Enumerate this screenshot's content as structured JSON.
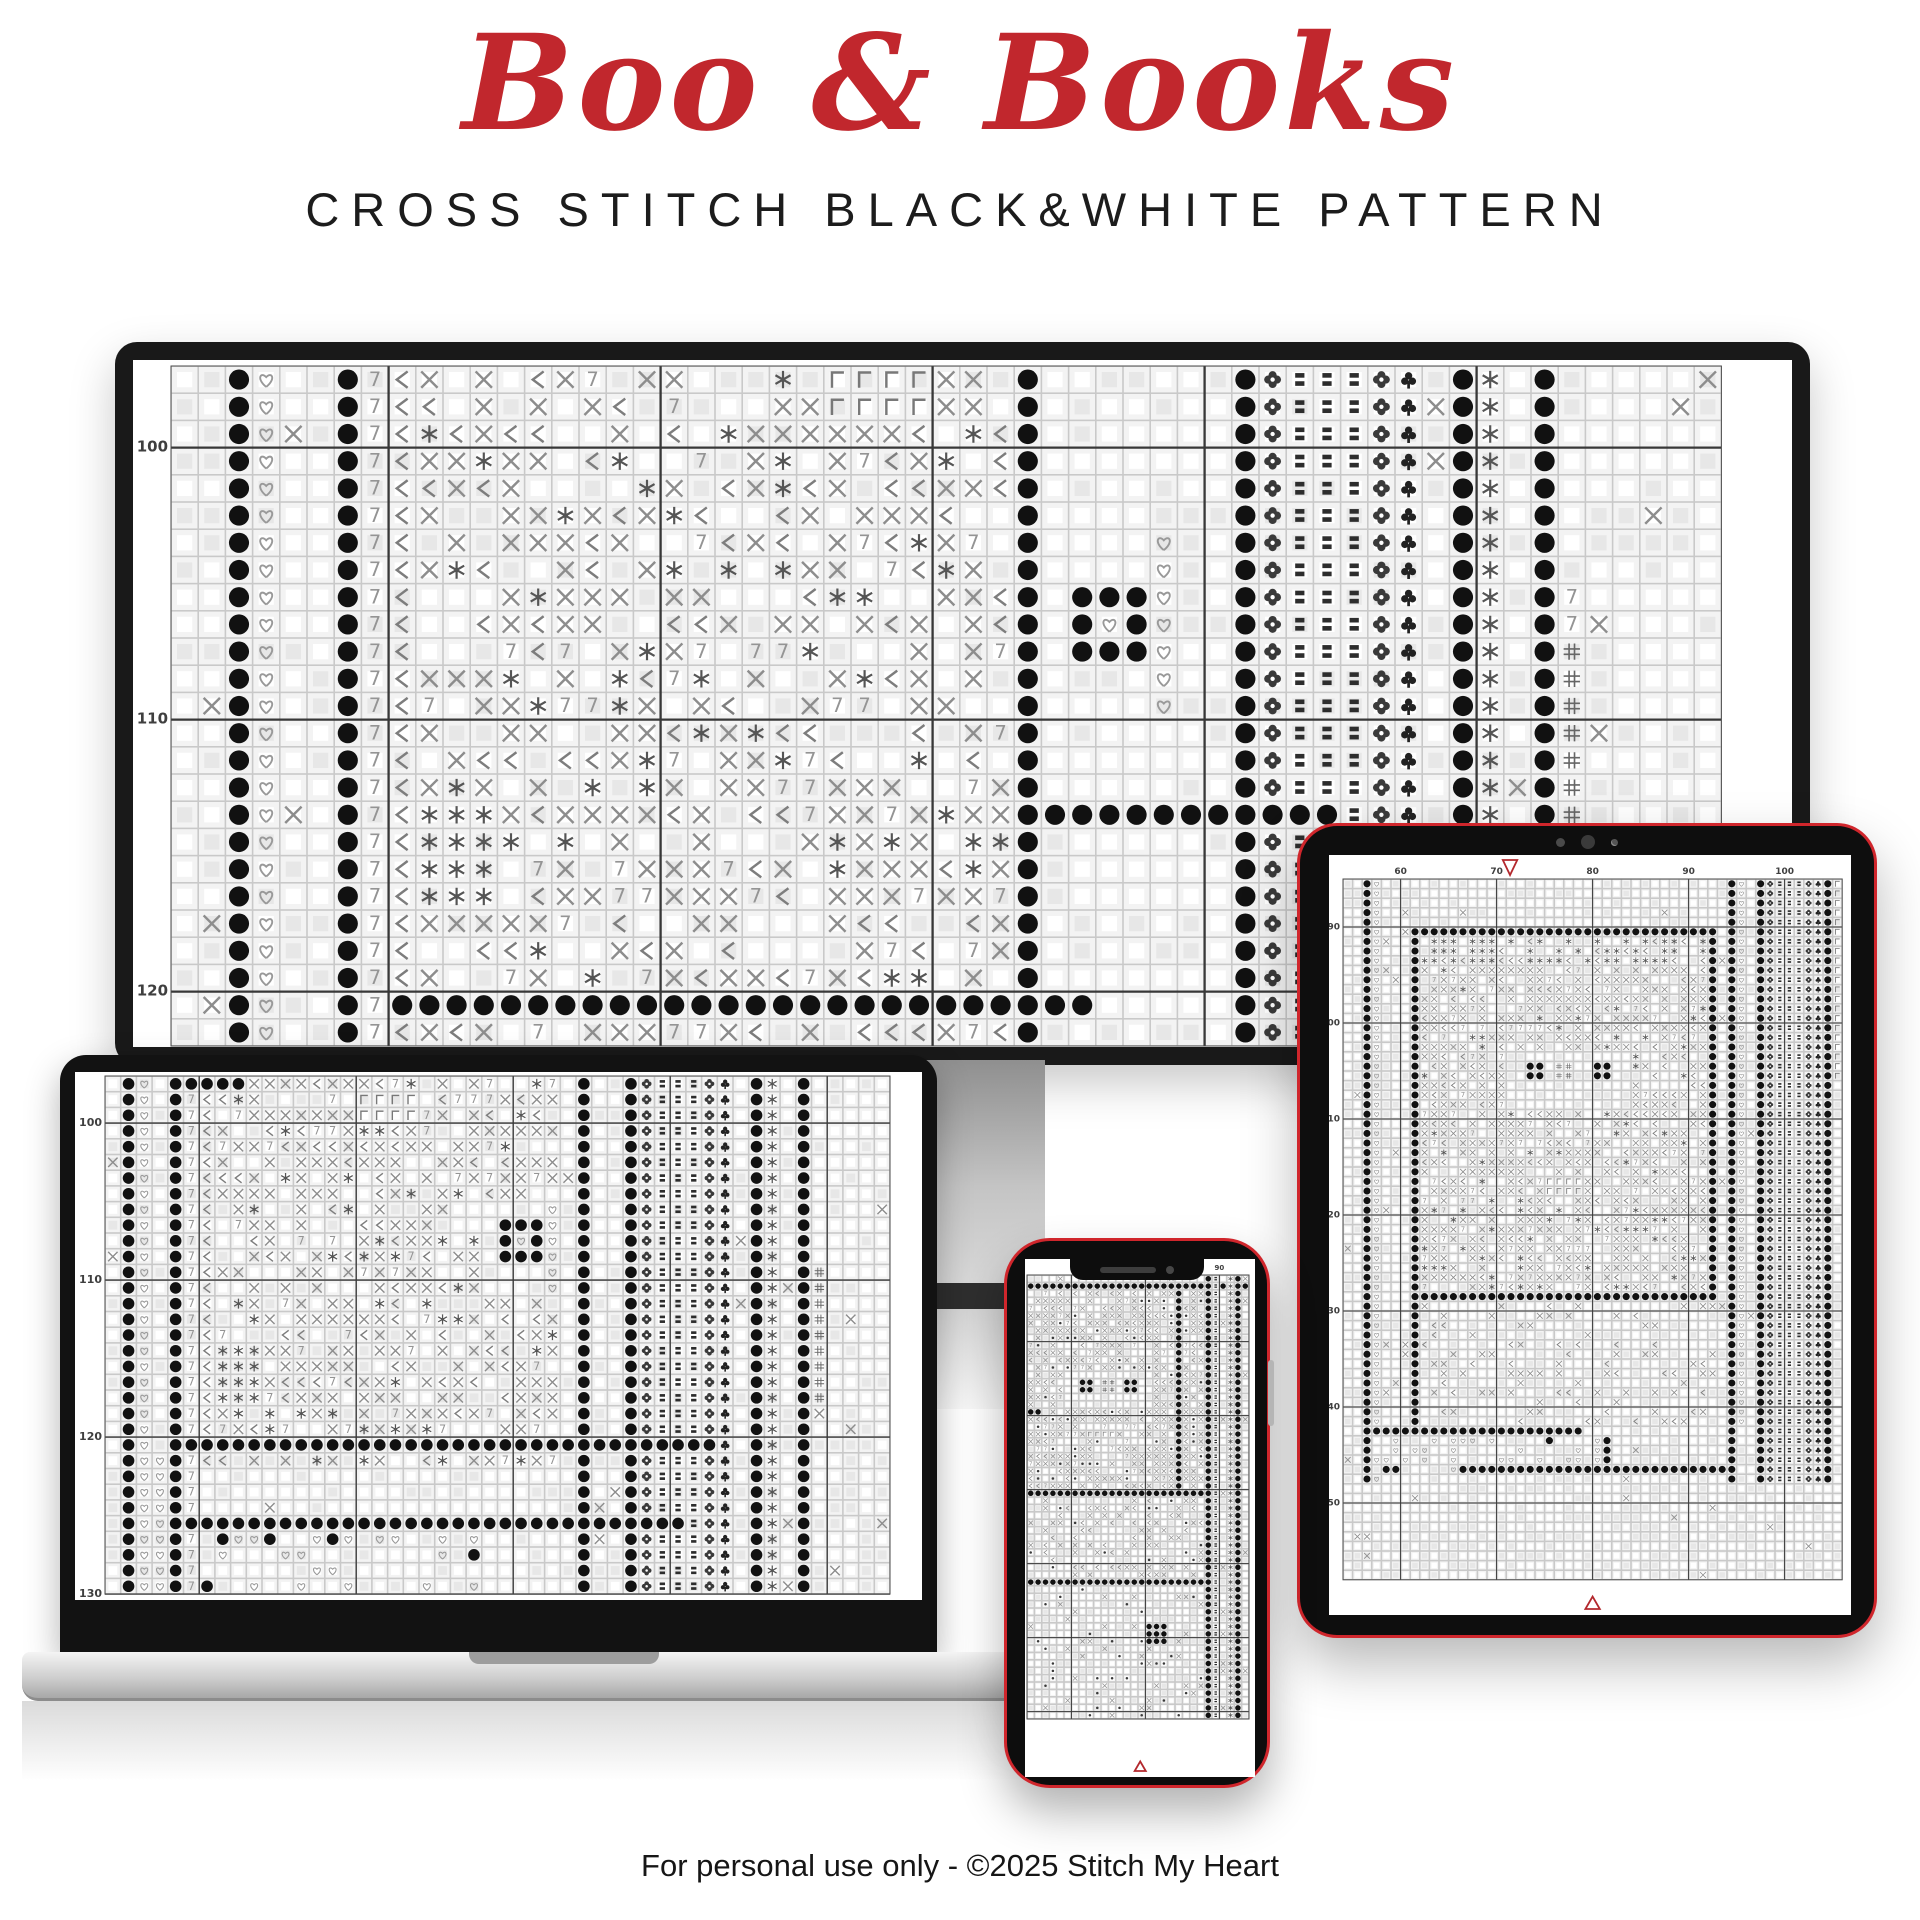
{
  "header": {
    "title": "Boo & Books",
    "subtitle": "CROSS STITCH BLACK&WHITE PATTERN",
    "title_color": "#C1272D",
    "subtitle_color": "#1c1c1c"
  },
  "footer": {
    "text": "For personal use only - ©2025 Stitch My Heart"
  },
  "colors": {
    "accent_red": "#C1272D",
    "device_frame_red": "#D0262C",
    "bezel_black": "#121212",
    "grid_line_major": "#383838",
    "label": "#3f3f3f",
    "marker_red": "#B3282D"
  },
  "symbols": {
    "legend": [
      "dot",
      "heart",
      "seven",
      "lt",
      "star",
      "x",
      "gamma",
      "hash",
      "flower",
      "club",
      "bars"
    ],
    "marker_down": "▽",
    "marker_up": "△"
  },
  "devices": {
    "monitor": {
      "name": "monitor",
      "canvas_w": 1659,
      "canvas_h": 687,
      "cell": 27.2,
      "cols": 57,
      "rows": 25,
      "margin_left": 38,
      "margin_top": 6,
      "thick_col_offset": 8,
      "thick_row_offset": 3,
      "label_font": 15,
      "seed": 7,
      "row_labels": {
        "rows": [
          3,
          13,
          23
        ],
        "values": [
          "100",
          "110",
          "120"
        ]
      },
      "col_labels": null,
      "top_marker_col": null,
      "bottom_marker_col": null,
      "zones": [
        {
          "t": "fill",
          "c0": 0,
          "c1": 57,
          "r0": 0,
          "r1": 25,
          "mix": [
            [
              "",
              0.96
            ],
            [
              "x",
              0.04
            ]
          ]
        },
        {
          "t": "col",
          "sym": "dot",
          "cols": [
            2,
            6,
            31,
            39,
            47,
            50
          ]
        },
        {
          "t": "col",
          "sym": "heart",
          "cols": [
            3
          ]
        },
        {
          "t": "col",
          "sym": "seven",
          "cols": [
            7
          ]
        },
        {
          "t": "fill",
          "c0": 9,
          "c1": 30,
          "r0": 0,
          "r1": 25,
          "mix": [
            [
              "x",
              0.4
            ],
            [
              "lt",
              0.13
            ],
            [
              "seven",
              0.08
            ],
            [
              "star",
              0.09
            ],
            [
              "",
              0.3
            ]
          ]
        },
        {
          "t": "col",
          "sym": "lt",
          "cols": [
            8
          ]
        },
        {
          "t": "rect",
          "sym": "star",
          "c0": 9,
          "c1": 11,
          "r0": 16,
          "r1": 19
        },
        {
          "t": "rect",
          "sym": "gamma",
          "c0": 24,
          "c1": 27,
          "r0": 0,
          "r1": 1
        },
        {
          "t": "rect",
          "sym": "",
          "c0": 32,
          "c1": 38,
          "r0": 0,
          "r1": 25
        },
        {
          "t": "rect",
          "sym": "dot",
          "c0": 33,
          "c1": 35,
          "r0": 8,
          "r1": 10
        },
        {
          "t": "rect",
          "sym": "heart",
          "c0": 34,
          "c1": 34,
          "r0": 9,
          "r1": 9
        },
        {
          "t": "col",
          "sym": "heart",
          "cols": [
            36
          ],
          "r0": 6,
          "r1": 12
        },
        {
          "t": "col",
          "sym": "flower",
          "cols": [
            40
          ]
        },
        {
          "t": "col",
          "sym": "bars",
          "cols": [
            41,
            42,
            43
          ]
        },
        {
          "t": "col",
          "sym": "flower",
          "cols": [
            44
          ]
        },
        {
          "t": "col",
          "sym": "club",
          "cols": [
            45
          ]
        },
        {
          "t": "col",
          "sym": "star",
          "cols": [
            48
          ]
        },
        {
          "t": "col",
          "sym": "seven",
          "cols": [
            51
          ],
          "r0": 8,
          "r1": 9
        },
        {
          "t": "col",
          "sym": "hash",
          "cols": [
            51
          ],
          "r0": 10,
          "r1": 16
        },
        {
          "t": "row",
          "sym": "dot",
          "rows": [
            23
          ],
          "c0": 8,
          "c1": 33
        },
        {
          "t": "row",
          "sym": "dot",
          "rows": [
            16
          ],
          "c0": 32,
          "c1": 42
        }
      ]
    },
    "laptop": {
      "name": "laptop",
      "canvas_w": 847,
      "canvas_h": 528,
      "cell": 15.7,
      "cols": 50,
      "rows": 33,
      "margin_left": 30,
      "margin_top": 4,
      "thick_col_offset": 6,
      "thick_row_offset": 3,
      "label_font": 11,
      "seed": 13,
      "row_labels": {
        "rows": [
          3,
          13,
          23,
          33
        ],
        "values": [
          "100",
          "110",
          "120",
          "130"
        ]
      },
      "col_labels": null,
      "top_marker_col": null,
      "bottom_marker_col": null,
      "zones": [
        {
          "t": "fill",
          "c0": 0,
          "c1": 50,
          "r0": 0,
          "r1": 33,
          "mix": [
            [
              "",
              0.95
            ],
            [
              "x",
              0.05
            ]
          ]
        },
        {
          "t": "col",
          "sym": "dot",
          "cols": [
            1,
            4,
            30,
            33,
            41,
            44
          ]
        },
        {
          "t": "col",
          "sym": "heart",
          "cols": [
            2
          ]
        },
        {
          "t": "col",
          "sym": "seven",
          "cols": [
            5
          ]
        },
        {
          "t": "fill",
          "c0": 7,
          "c1": 28,
          "r0": 0,
          "r1": 24,
          "mix": [
            [
              "x",
              0.4
            ],
            [
              "lt",
              0.13
            ],
            [
              "seven",
              0.08
            ],
            [
              "star",
              0.09
            ],
            [
              "",
              0.3
            ]
          ]
        },
        {
          "t": "col",
          "sym": "lt",
          "cols": [
            6
          ],
          "r0": 0,
          "r1": 24
        },
        {
          "t": "rect",
          "sym": "dot",
          "c0": 5,
          "c1": 8,
          "r0": 0,
          "r1": 0
        },
        {
          "t": "rect",
          "sym": "gamma",
          "c0": 16,
          "c1": 19,
          "r0": 1,
          "r1": 2
        },
        {
          "t": "rect",
          "sym": "star",
          "c0": 7,
          "c1": 9,
          "r0": 17,
          "r1": 20
        },
        {
          "t": "rect",
          "sym": "",
          "c0": 24,
          "c1": 28,
          "r0": 8,
          "r1": 13
        },
        {
          "t": "rect",
          "sym": "dot",
          "c0": 25,
          "c1": 27,
          "r0": 9,
          "r1": 11
        },
        {
          "t": "rect",
          "sym": "heart",
          "c0": 26,
          "c1": 26,
          "r0": 10,
          "r1": 10
        },
        {
          "t": "col",
          "sym": "heart",
          "cols": [
            28
          ],
          "r0": 8,
          "r1": 13
        },
        {
          "t": "col",
          "sym": "flower",
          "cols": [
            34
          ]
        },
        {
          "t": "col",
          "sym": "bars",
          "cols": [
            35,
            36,
            37
          ]
        },
        {
          "t": "col",
          "sym": "flower",
          "cols": [
            38
          ]
        },
        {
          "t": "col",
          "sym": "club",
          "cols": [
            39
          ]
        },
        {
          "t": "col",
          "sym": "star",
          "cols": [
            42
          ]
        },
        {
          "t": "col",
          "sym": "hash",
          "cols": [
            45
          ],
          "r0": 12,
          "r1": 20
        },
        {
          "t": "row",
          "sym": "dot",
          "rows": [
            23
          ],
          "c0": 4,
          "c1": 38
        },
        {
          "t": "row",
          "sym": "dot",
          "rows": [
            28
          ],
          "c0": 5,
          "c1": 36
        },
        {
          "t": "col",
          "sym": "heart",
          "cols": [
            3
          ],
          "r0": 24,
          "r1": 33
        },
        {
          "t": "fill",
          "c0": 6,
          "c1": 23,
          "r0": 29,
          "r1": 33,
          "mix": [
            [
              "heart",
              0.18
            ],
            [
              "",
              0.76
            ],
            [
              "dot",
              0.06
            ]
          ]
        }
      ]
    },
    "tablet": {
      "name": "tablet",
      "canvas_w": 522,
      "canvas_h": 760,
      "cell": 9.6,
      "cols": 52,
      "rows": 73,
      "margin_left": 14,
      "margin_top": 24,
      "thick_col_offset": 6,
      "thick_row_offset": 5,
      "label_font": 9,
      "seed": 21,
      "row_labels": {
        "rows": [
          5,
          15,
          25,
          35,
          45,
          55,
          65
        ],
        "values": [
          "90",
          "100",
          "110",
          "120",
          "130",
          "140",
          "150"
        ]
      },
      "col_labels": {
        "cols": [
          6,
          16,
          26,
          36,
          46
        ],
        "values": [
          "60",
          "70",
          "80",
          "90",
          "100"
        ]
      },
      "top_marker_col": 17.4,
      "bottom_marker_col": 26,
      "zones": [
        {
          "t": "fill",
          "c0": 0,
          "c1": 52,
          "r0": 0,
          "r1": 73,
          "mix": [
            [
              "",
              0.96
            ],
            [
              "x",
              0.04
            ]
          ]
        },
        {
          "t": "col",
          "sym": "dot",
          "cols": [
            2,
            40,
            43,
            50
          ]
        },
        {
          "t": "col",
          "sym": "heart",
          "cols": [
            3
          ]
        },
        {
          "t": "col",
          "sym": "heart",
          "cols": [
            41
          ],
          "r0": 0,
          "r1": 56
        },
        {
          "t": "col",
          "sym": "flower",
          "cols": [
            44
          ]
        },
        {
          "t": "col",
          "sym": "bars",
          "cols": [
            45,
            46,
            47
          ]
        },
        {
          "t": "col",
          "sym": "flower",
          "cols": [
            48
          ]
        },
        {
          "t": "col",
          "sym": "club",
          "cols": [
            49
          ]
        },
        {
          "t": "col",
          "sym": "gamma",
          "cols": [
            51
          ],
          "r0": 0,
          "r1": 20
        },
        {
          "t": "fill",
          "c0": 8,
          "c1": 37,
          "r0": 6,
          "r1": 43,
          "mix": [
            [
              "x",
              0.42
            ],
            [
              "lt",
              0.12
            ],
            [
              "seven",
              0.08
            ],
            [
              "star",
              0.08
            ],
            [
              "",
              0.3
            ]
          ]
        },
        {
          "t": "fill",
          "c0": 8,
          "c1": 37,
          "r0": 6,
          "r1": 8,
          "mix": [
            [
              "star",
              0.5
            ],
            [
              "lt",
              0.2
            ],
            [
              "",
              0.3
            ]
          ]
        },
        {
          "t": "col",
          "sym": "dot",
          "cols": [
            7
          ],
          "r0": 5,
          "r1": 57
        },
        {
          "t": "col",
          "sym": "dot",
          "cols": [
            38
          ],
          "r0": 5,
          "r1": 43
        },
        {
          "t": "row",
          "sym": "dot",
          "rows": [
            5
          ],
          "c0": 7,
          "c1": 38
        },
        {
          "t": "row",
          "sym": "dot",
          "rows": [
            43
          ],
          "c0": 7,
          "c1": 38
        },
        {
          "t": "rect",
          "sym": "",
          "c0": 17,
          "c1": 29,
          "r0": 18,
          "r1": 23
        },
        {
          "t": "rect",
          "sym": "dot",
          "c0": 19,
          "c1": 20,
          "r0": 19,
          "r1": 20
        },
        {
          "t": "rect",
          "sym": "dot",
          "c0": 26,
          "c1": 27,
          "r0": 19,
          "r1": 20
        },
        {
          "t": "rect",
          "sym": "hash",
          "c0": 22,
          "c1": 23,
          "r0": 19,
          "r1": 20
        },
        {
          "t": "rect",
          "sym": "gamma",
          "c0": 21,
          "c1": 24,
          "r0": 31,
          "r1": 32
        },
        {
          "t": "fill",
          "c0": 8,
          "c1": 37,
          "r0": 44,
          "r1": 56,
          "mix": [
            [
              "",
              0.75
            ],
            [
              "x",
              0.15
            ],
            [
              "lt",
              0.1
            ]
          ]
        },
        {
          "t": "row",
          "sym": "dot",
          "rows": [
            57
          ],
          "c0": 2,
          "c1": 24
        },
        {
          "t": "fill",
          "c0": 3,
          "c1": 24,
          "r0": 58,
          "r1": 61,
          "mix": [
            [
              "heart",
              0.3
            ],
            [
              "",
              0.62
            ],
            [
              "dot",
              0.08
            ]
          ]
        },
        {
          "t": "rect",
          "sym": "heart",
          "c0": 26,
          "c1": 26,
          "r0": 58,
          "r1": 60
        },
        {
          "t": "rect",
          "sym": "dot",
          "c0": 27,
          "c1": 27,
          "r0": 58,
          "r1": 60
        },
        {
          "t": "row",
          "sym": "dot",
          "rows": [
            61
          ],
          "c0": 12,
          "c1": 40
        },
        {
          "t": "fill",
          "c0": 0,
          "c1": 52,
          "r0": 63,
          "r1": 73,
          "mix": [
            [
              "",
              0.97
            ],
            [
              "x",
              0.03
            ]
          ]
        }
      ]
    },
    "phone": {
      "name": "phone",
      "canvas_w": 230,
      "canvas_h": 518,
      "cell": 7.4,
      "cols": 30,
      "rows": 60,
      "margin_left": 2,
      "margin_top": 16,
      "thick_col_offset": 6,
      "thick_row_offset": 9,
      "label_font": 7,
      "seed": 29,
      "row_labels": null,
      "col_labels": {
        "cols": [
          26
        ],
        "values": [
          "90"
        ]
      },
      "top_marker_col": null,
      "bottom_marker_col": 15.3,
      "zones": [
        {
          "t": "fill",
          "c0": 0,
          "c1": 30,
          "r0": 0,
          "r1": 60,
          "mix": [
            [
              "",
              0.9
            ],
            [
              "x",
              0.1
            ]
          ]
        },
        {
          "t": "fill",
          "c0": 0,
          "c1": 23,
          "r0": 2,
          "r1": 29,
          "mix": [
            [
              "x",
              0.38
            ],
            [
              "lt",
              0.15
            ],
            [
              "seven",
              0.07
            ],
            [
              "dotS",
              0.1
            ],
            [
              "",
              0.3
            ]
          ]
        },
        {
          "t": "row",
          "sym": "dot",
          "rows": [
            1
          ],
          "c0": 0,
          "c1": 29
        },
        {
          "t": "col",
          "sym": "dot",
          "cols": [
            20
          ],
          "r0": 2,
          "r1": 59
        },
        {
          "t": "col",
          "sym": "dot",
          "cols": [
            24
          ],
          "r0": 0,
          "r1": 59
        },
        {
          "t": "col",
          "sym": "bars",
          "cols": [
            25
          ],
          "r0": 0,
          "r1": 59
        },
        {
          "t": "col",
          "sym": "star",
          "cols": [
            27
          ],
          "r0": 0,
          "r1": 59
        },
        {
          "t": "col",
          "sym": "dot",
          "cols": [
            28
          ],
          "r0": 0,
          "r1": 59
        },
        {
          "t": "rect",
          "sym": "",
          "c0": 5,
          "c1": 16,
          "r0": 13,
          "r1": 17
        },
        {
          "t": "rect",
          "sym": "dot",
          "c0": 7,
          "c1": 8,
          "r0": 14,
          "r1": 15
        },
        {
          "t": "rect",
          "sym": "dot",
          "c0": 13,
          "c1": 14,
          "r0": 14,
          "r1": 15
        },
        {
          "t": "rect",
          "sym": "hash",
          "c0": 10,
          "c1": 11,
          "r0": 14,
          "r1": 15
        },
        {
          "t": "rect",
          "sym": "dot",
          "c0": 0,
          "c1": 1,
          "r0": 18,
          "r1": 18
        },
        {
          "t": "rect",
          "sym": "gamma",
          "c0": 8,
          "c1": 11,
          "r0": 21,
          "r1": 21
        },
        {
          "t": "row",
          "sym": "dot",
          "rows": [
            29
          ],
          "c0": 0,
          "c1": 23
        },
        {
          "t": "fill",
          "c0": 0,
          "c1": 23,
          "r0": 30,
          "r1": 41,
          "mix": [
            [
              "",
              0.7
            ],
            [
              "x",
              0.15
            ],
            [
              "lt",
              0.08
            ],
            [
              "dotS",
              0.07
            ]
          ]
        },
        {
          "t": "row",
          "sym": "dot",
          "rows": [
            41
          ],
          "c0": 0,
          "c1": 23
        },
        {
          "t": "fill",
          "c0": 0,
          "c1": 23,
          "r0": 42,
          "r1": 60,
          "mix": [
            [
              "",
              0.85
            ],
            [
              "x",
              0.08
            ],
            [
              "dotS",
              0.07
            ]
          ]
        },
        {
          "t": "rect",
          "sym": "dot",
          "c0": 16,
          "c1": 18,
          "r0": 47,
          "r1": 49
        }
      ]
    }
  }
}
